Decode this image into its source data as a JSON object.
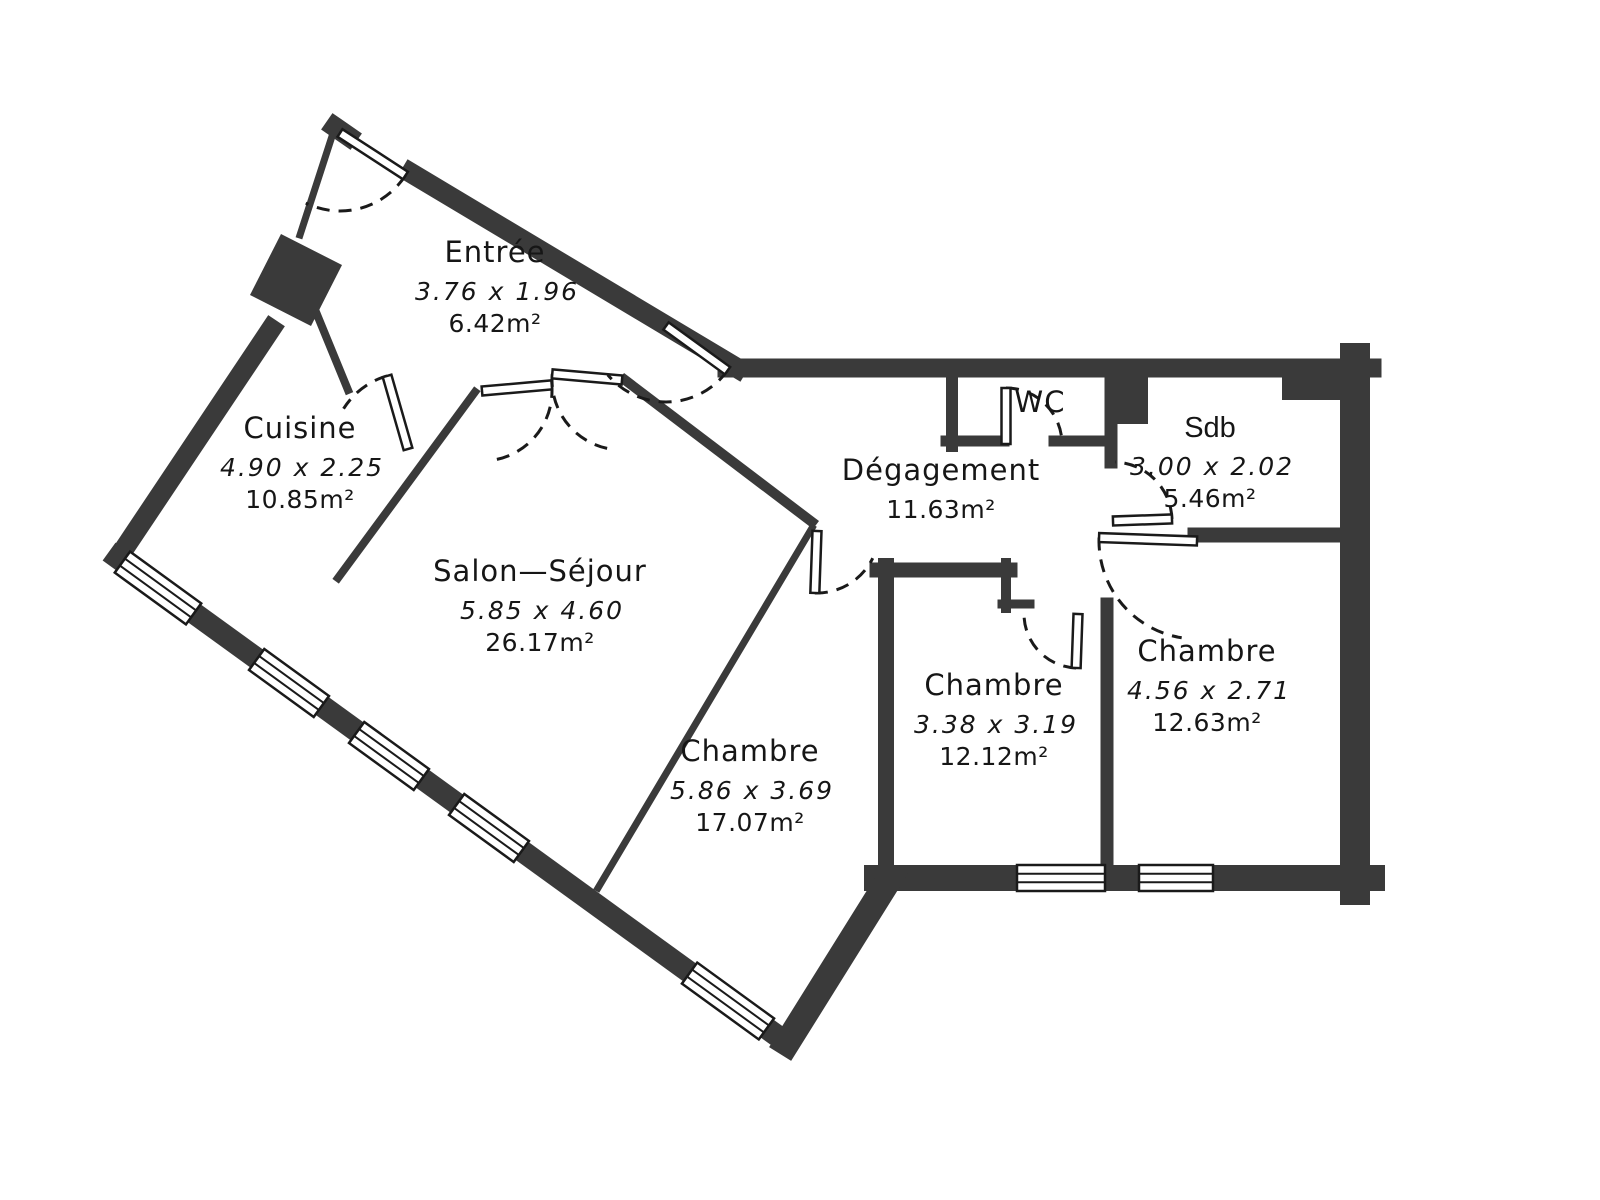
{
  "colors": {
    "wall": "#3a3a3a",
    "line": "#1a1a1a",
    "bg": "#ffffff"
  },
  "rooms": [
    {
      "name": "Entrée",
      "dims": "3.76 x 1.96",
      "area": "6.42m²",
      "x": 495,
      "y": 262
    },
    {
      "name": "Cuisine",
      "dims": "4.90 x 2.25",
      "area": "10.85m²",
      "x": 300,
      "y": 438
    },
    {
      "name": "Salon—Séjour",
      "dims": "5.85 x 4.60",
      "area": "26.17m²",
      "x": 540,
      "y": 581
    },
    {
      "name": "Dégagement",
      "dims": "",
      "area": "11.63m²",
      "x": 941,
      "y": 480
    },
    {
      "name": "WC",
      "dims": "",
      "area": "",
      "x": 1040,
      "y": 412,
      "size": 26
    },
    {
      "name": "Sdb",
      "dims": "3.00 x 2.02",
      "area": "5.46m²",
      "x": 1210,
      "y": 437,
      "size": 27,
      "alt": true
    },
    {
      "name": "Chambre",
      "dims": "5.86 x 3.69",
      "area": "17.07m²",
      "x": 750,
      "y": 761
    },
    {
      "name": "Chambre",
      "dims": "3.38 x 3.19",
      "area": "12.12m²",
      "x": 994,
      "y": 695
    },
    {
      "name": "Chambre",
      "dims": "4.56 x 2.71",
      "area": "12.63m²",
      "x": 1207,
      "y": 661
    }
  ],
  "geometry": {
    "walls": [
      [
        335,
        127,
        348,
        136,
        20
      ],
      [
        411,
        173,
        737,
        368,
        20
      ],
      [
        727,
        368,
        1372,
        368,
        19
      ],
      [
        1355,
        358,
        1355,
        890,
        30
      ],
      [
        877,
        878,
        1372,
        878,
        26
      ],
      [
        890,
        878,
        787,
        1043,
        26
      ],
      [
        787,
        1043,
        118,
        558,
        22
      ],
      [
        118,
        558,
        271,
        329,
        20
      ],
      [
        335,
        127,
        300,
        235,
        7
      ],
      [
        316,
        312,
        348,
        390,
        8
      ],
      [
        338,
        578,
        475,
        392,
        8
      ],
      [
        625,
        380,
        812,
        522,
        10
      ],
      [
        812,
        528,
        598,
        888,
        7
      ],
      [
        886,
        566,
        886,
        878,
        16
      ],
      [
        877,
        570,
        1010,
        570,
        15
      ],
      [
        1006,
        563,
        1006,
        608,
        10
      ],
      [
        1002,
        604,
        1030,
        604,
        9
      ],
      [
        1107,
        604,
        1107,
        878,
        13
      ],
      [
        1195,
        535,
        1348,
        535,
        15
      ],
      [
        1111,
        377,
        1111,
        462,
        13
      ],
      [
        952,
        377,
        952,
        446,
        12
      ],
      [
        946,
        441,
        1004,
        441,
        11
      ],
      [
        1054,
        441,
        1111,
        441,
        11
      ]
    ],
    "blocks": [
      "311,326 250,295 281,234 342,265",
      "1115,360 1148,360 1148,424 1115,424",
      "1282,368 1345,368 1345,400 1282,400"
    ],
    "windows": [
      [
        158,
        588,
        88,
        36
      ],
      [
        289,
        683,
        80,
        36
      ],
      [
        389,
        756,
        80,
        36
      ],
      [
        489,
        828,
        80,
        36
      ],
      [
        728,
        1001,
        95,
        36
      ],
      [
        1061,
        878,
        88,
        0
      ],
      [
        1176,
        878,
        74,
        0
      ]
    ],
    "doors": [
      [
        340,
        133,
        78,
        33,
        116
      ],
      [
        408,
        449,
        76,
        254,
        212
      ],
      [
        482,
        391,
        70,
        355,
        85
      ],
      [
        622,
        380,
        70,
        185,
        95
      ],
      [
        666,
        326,
        76,
        36,
        140
      ],
      [
        1006,
        444,
        56,
        270,
        358
      ],
      [
        1113,
        521,
        59,
        358,
        272
      ],
      [
        1197,
        541,
        98,
        182,
        99
      ],
      [
        817,
        531,
        62,
        92,
        26
      ],
      [
        1078,
        614,
        54,
        92,
        178
      ]
    ]
  }
}
